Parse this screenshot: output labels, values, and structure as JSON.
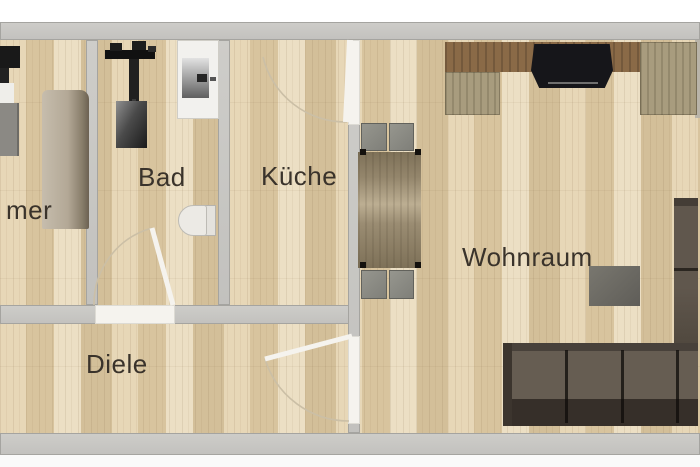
{
  "palette": {
    "background": "#ffffff",
    "floor_wood": "#dcc9a4",
    "wall_gray": "#c6c5c2",
    "door_white": "#f5f3ee",
    "label_color": "#3a332b",
    "desk_brown": "#8a6a47",
    "panel_olive": "#a89c7e",
    "sofa_brown": "#564e46"
  },
  "rooms": [
    {
      "id": "zimmer-cropped",
      "label": "mer"
    },
    {
      "id": "bad",
      "label": "Bad"
    },
    {
      "id": "kueche",
      "label": "Küche"
    },
    {
      "id": "diele",
      "label": "Diele"
    },
    {
      "id": "wohnraum",
      "label": "Wohnraum"
    }
  ],
  "doors": [
    "bad-to-diele",
    "kueche-to-wohnraum",
    "diele-to-wohnraum"
  ],
  "furniture": [
    "wardrobe",
    "shower",
    "sink-unit",
    "toilet",
    "dining-table",
    "dining-chair",
    "desk",
    "desk-chair",
    "side-panel",
    "coffee-table",
    "corner-sofa",
    "cropped-cabinet",
    "cropped-tv"
  ]
}
